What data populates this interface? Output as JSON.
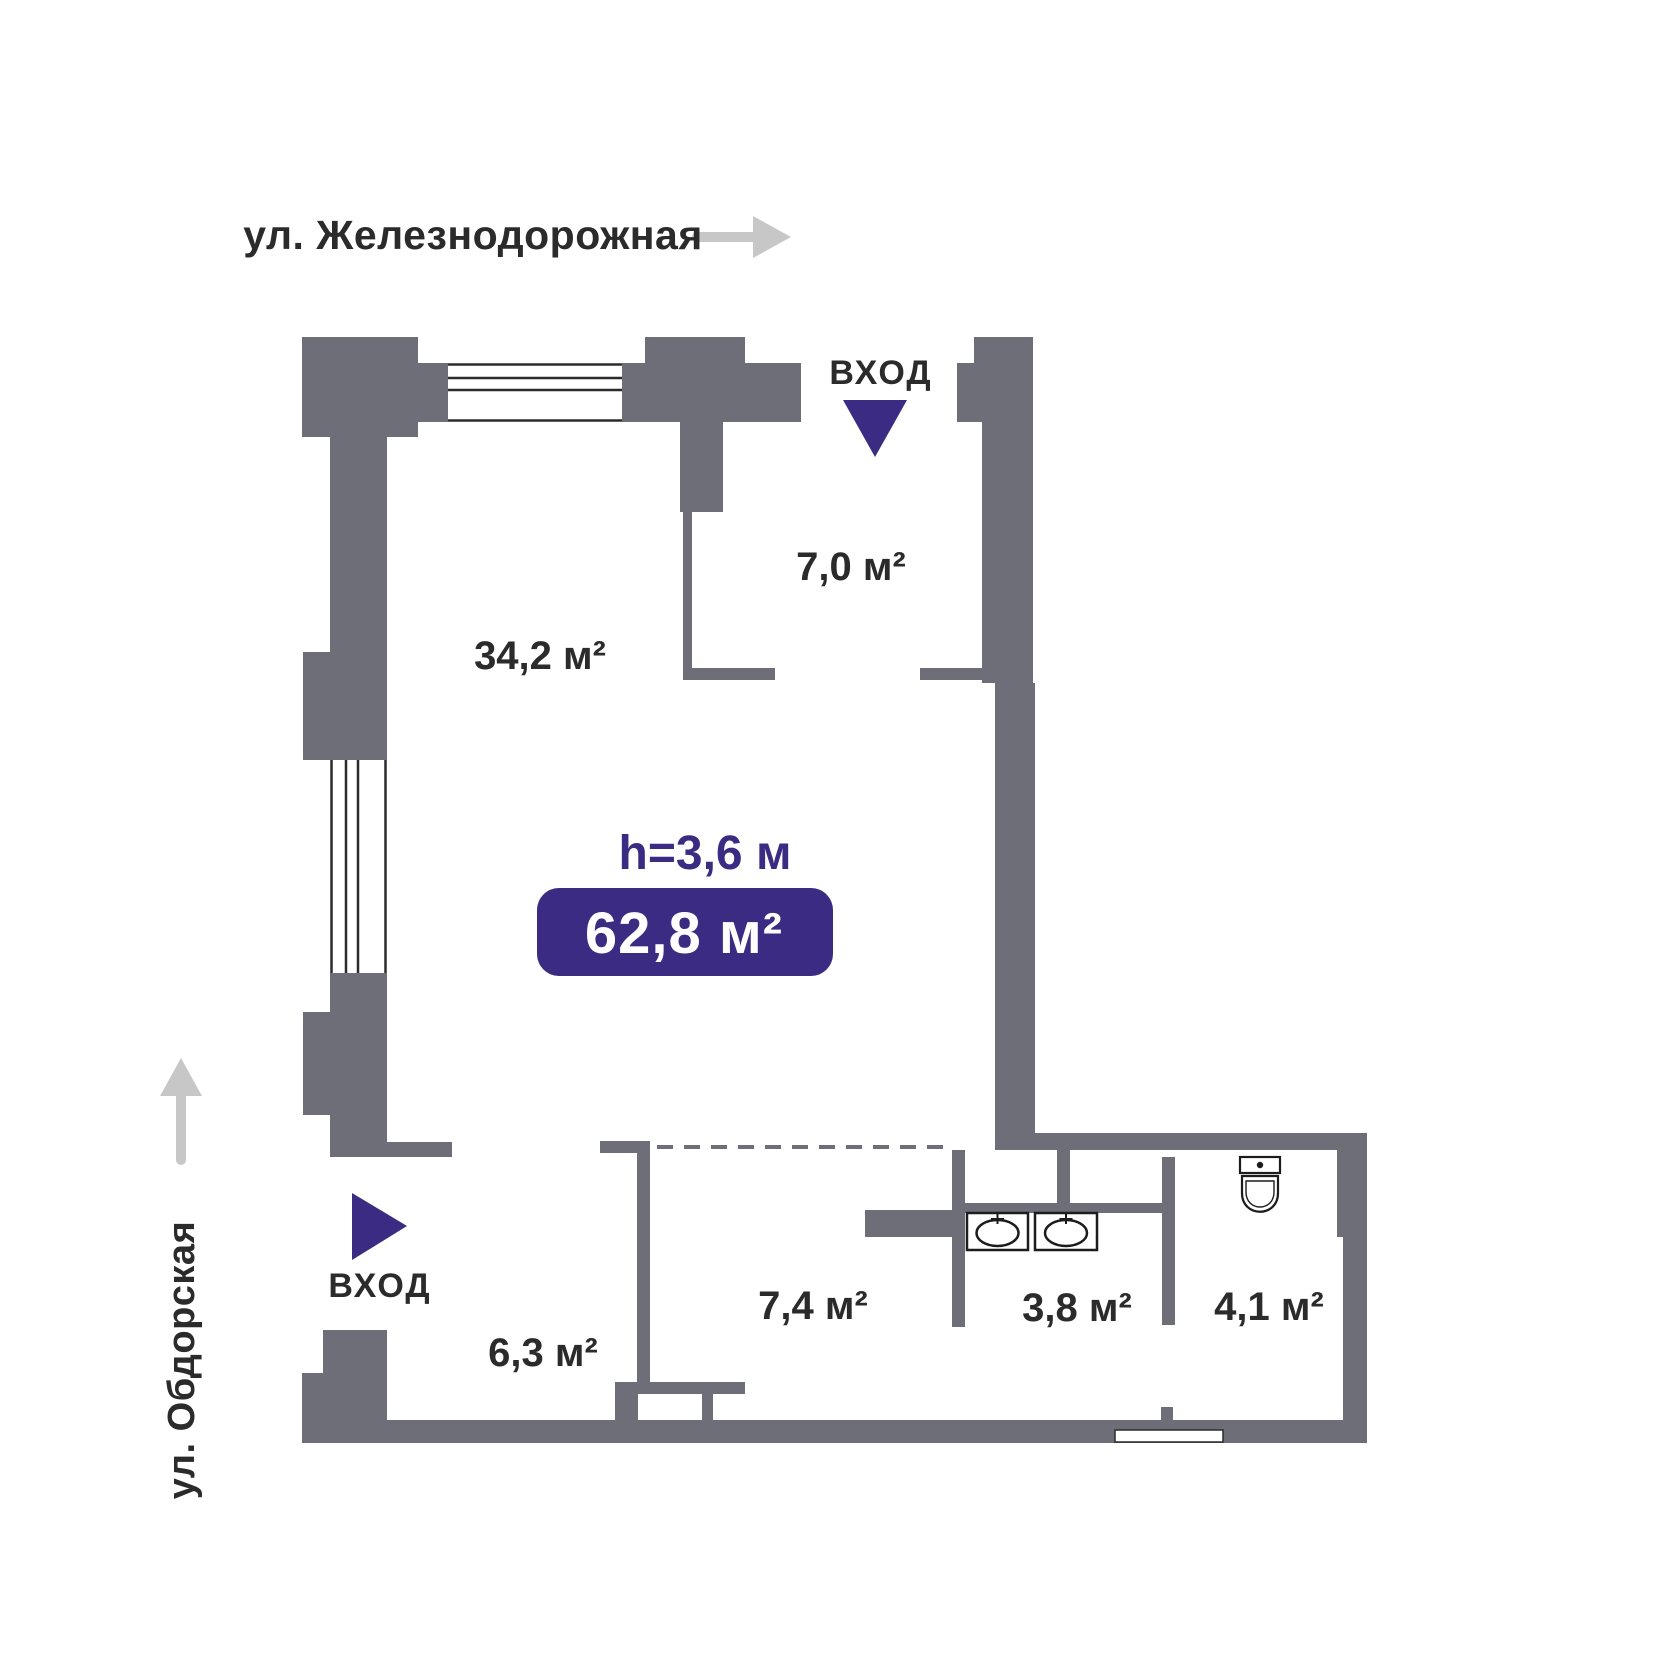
{
  "colors": {
    "wall_gray": "#6e6e79",
    "accent_purple": "#3c2b82",
    "text_dark": "#2b2b2b",
    "street_arrow_gray": "#c7c7c7",
    "fixture_stroke": "#1c1c1c"
  },
  "streets": {
    "top": {
      "label": "ул. Железнодорожная",
      "direction": "right"
    },
    "left": {
      "label": "ул. Обдорская",
      "direction": "up"
    }
  },
  "entrances": {
    "top": {
      "label": "ВХОД"
    },
    "left": {
      "label": "ВХОД"
    }
  },
  "plan": {
    "ceiling_height": "h=3,6 м",
    "total_area": "62,8 м²",
    "rooms": [
      {
        "name": "main-room",
        "area": "34,2 м²"
      },
      {
        "name": "entry-vestibule",
        "area": "7,0 м²"
      },
      {
        "name": "hall",
        "area": "6,3 м²"
      },
      {
        "name": "corridor",
        "area": "7,4 м²"
      },
      {
        "name": "washroom",
        "area": "3,8 м²"
      },
      {
        "name": "wc",
        "area": "4,1 м²"
      }
    ]
  }
}
